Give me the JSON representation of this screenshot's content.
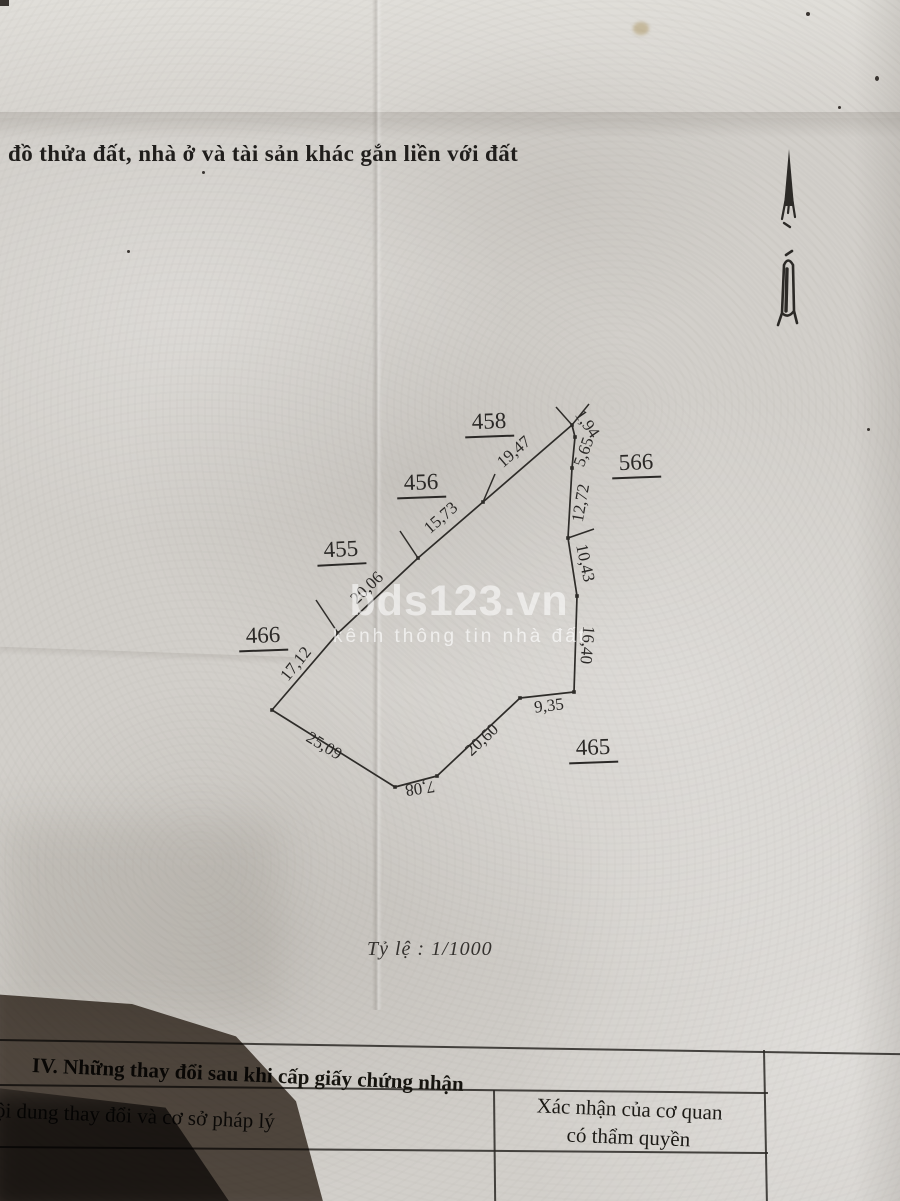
{
  "colors": {
    "paper": "#d2cfca",
    "ink": "#2b2927",
    "boundary_line": "#2e2c29",
    "watermark": "#ffffff"
  },
  "header": {
    "title": "đồ thửa đất, nhà ở và tài sản khác gắn liền với đất"
  },
  "watermark": {
    "brand": "bds123.vn",
    "tagline": "kênh thông tin nhà đất"
  },
  "scale": {
    "label": "Tỷ lệ : 1/1000"
  },
  "section_iv": {
    "heading": "IV. Những thay đổi sau khi cấp giấy chứng nhận",
    "left_column_header": "ội dung thay đổi và cơ sở pháp lý",
    "right_column_header_line1": "Xác nhận của cơ quan",
    "right_column_header_line2": "có thẩm quyền"
  },
  "parcel_map": {
    "vertices": [
      [
        572,
        425
      ],
      [
        575,
        437
      ],
      [
        572,
        468
      ],
      [
        568,
        538
      ],
      [
        577,
        596
      ],
      [
        574,
        692
      ],
      [
        520,
        698
      ],
      [
        437,
        776
      ],
      [
        395,
        787
      ],
      [
        272,
        710
      ],
      [
        338,
        633
      ],
      [
        418,
        558
      ],
      [
        483,
        502
      ]
    ],
    "ticks": [
      [
        483,
        502,
        495,
        474
      ],
      [
        418,
        558,
        400,
        531
      ],
      [
        338,
        633,
        316,
        600
      ],
      [
        568,
        538,
        594,
        529
      ],
      [
        572,
        425,
        556,
        407
      ],
      [
        572,
        425,
        589,
        404
      ]
    ],
    "edge_labels": [
      {
        "text": "19,47",
        "x": 514,
        "y": 452,
        "rot": -41
      },
      {
        "text": "15,73",
        "x": 441,
        "y": 518,
        "rot": -41
      },
      {
        "text": "20,06",
        "x": 367,
        "y": 588,
        "rot": -44
      },
      {
        "text": "17,12",
        "x": 296,
        "y": 664,
        "rot": -51
      },
      {
        "text": "25,09",
        "x": 324,
        "y": 746,
        "rot": 31
      },
      {
        "text": "7,08",
        "x": 420,
        "y": 788,
        "rot": 172
      },
      {
        "text": "20,60",
        "x": 482,
        "y": 740,
        "rot": -43
      },
      {
        "text": "9,35",
        "x": 549,
        "y": 706,
        "rot": -7
      },
      {
        "text": "16,40",
        "x": 587,
        "y": 645,
        "rot": 95
      },
      {
        "text": "10,43",
        "x": 585,
        "y": 563,
        "rot": 78
      },
      {
        "text": "12,72",
        "x": 581,
        "y": 503,
        "rot": -80
      },
      {
        "text": "5,65",
        "x": 584,
        "y": 452,
        "rot": -70
      },
      {
        "text": "1,94",
        "x": 587,
        "y": 424,
        "rot": 55
      }
    ],
    "plot_labels": [
      {
        "text": "458",
        "x": 489,
        "y": 423,
        "rot": -2
      },
      {
        "text": "456",
        "x": 421,
        "y": 484,
        "rot": -2
      },
      {
        "text": "455",
        "x": 341,
        "y": 551,
        "rot": -3
      },
      {
        "text": "466",
        "x": 263,
        "y": 637,
        "rot": -2
      },
      {
        "text": "566",
        "x": 636,
        "y": 464,
        "rot": -2
      },
      {
        "text": "465",
        "x": 593,
        "y": 749,
        "rot": -2
      }
    ]
  }
}
